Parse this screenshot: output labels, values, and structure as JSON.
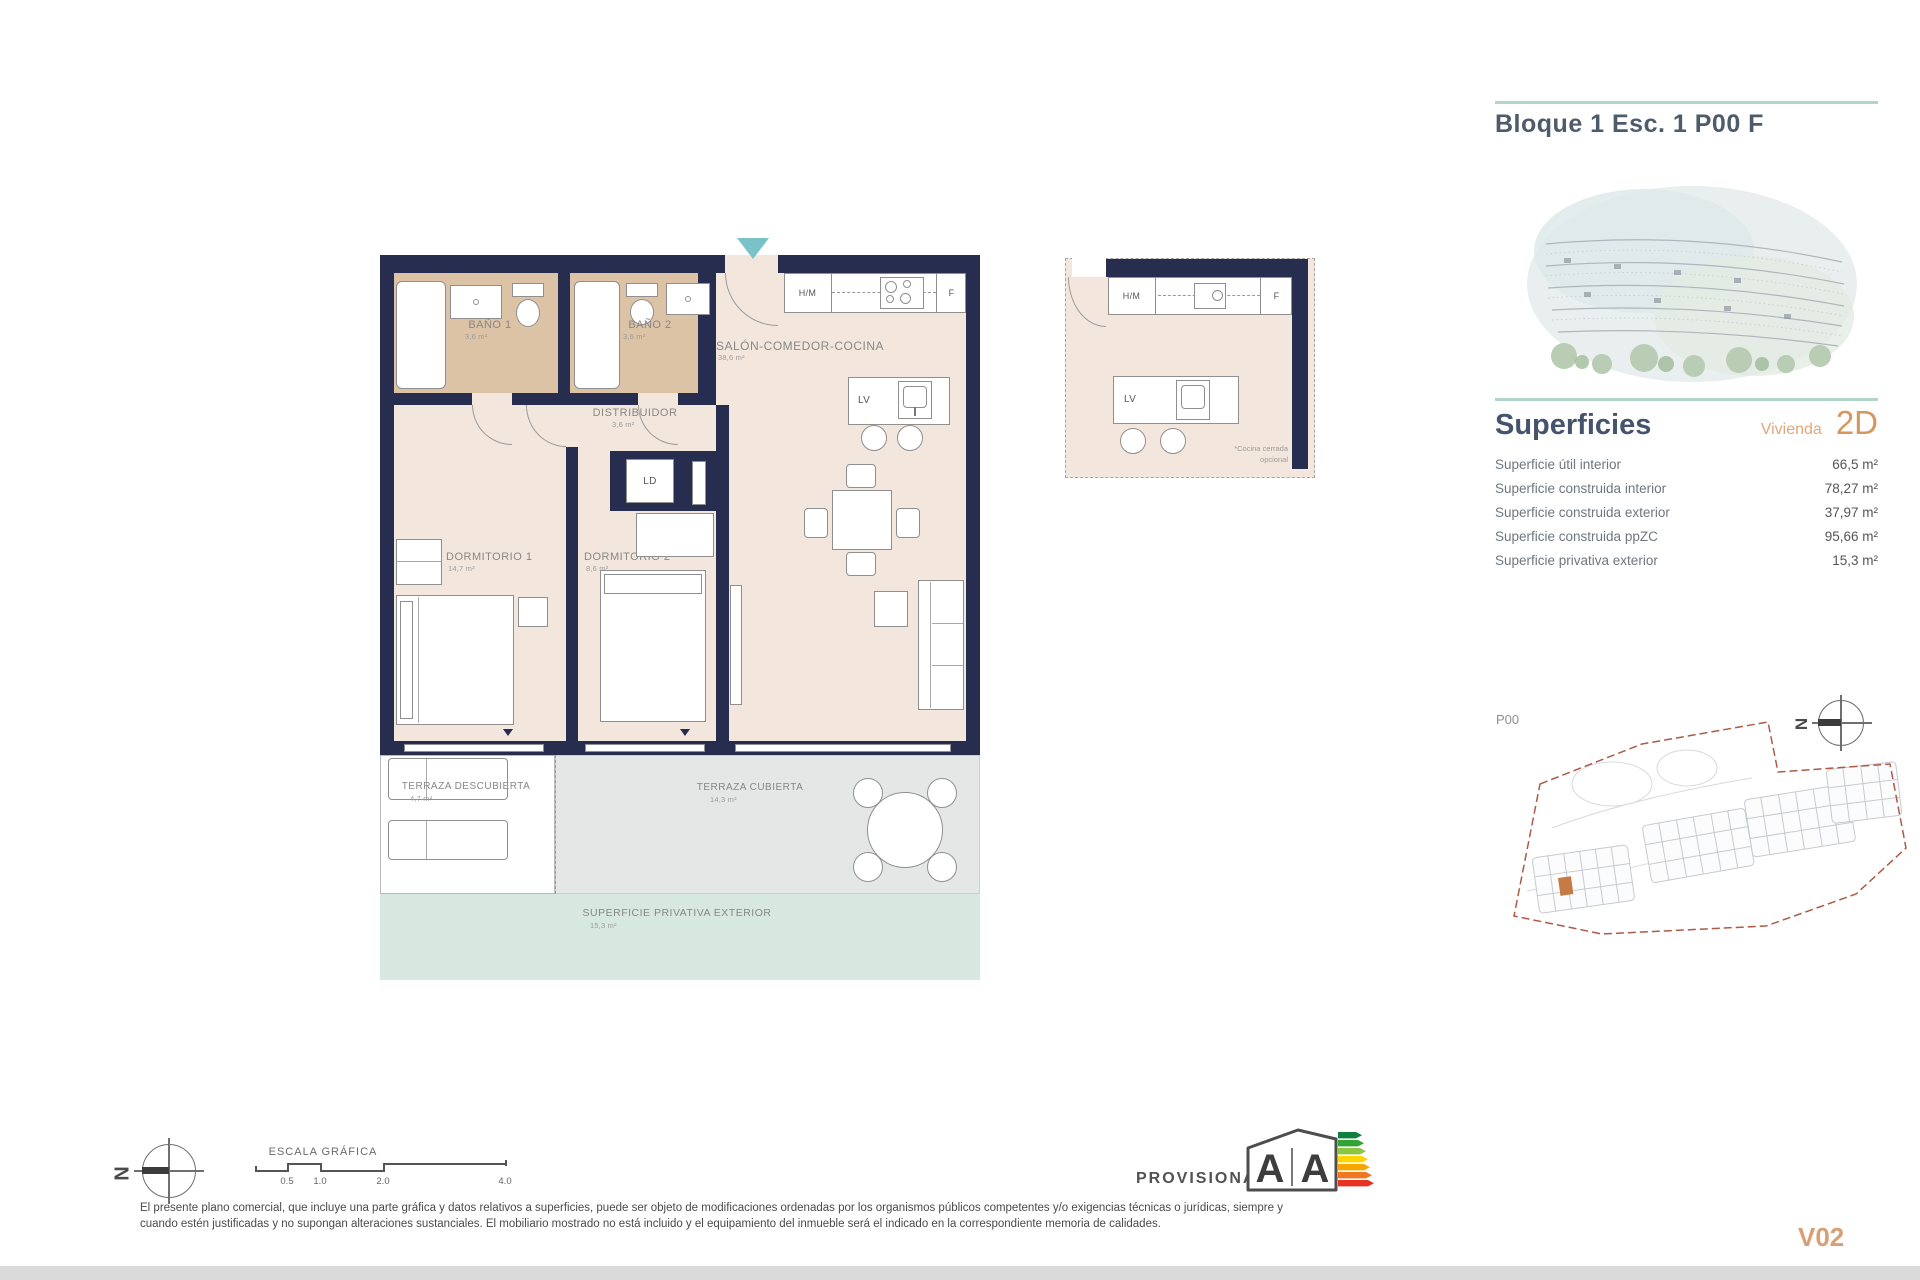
{
  "header": {
    "title": "Bloque 1 Esc. 1 P00 F"
  },
  "superficies": {
    "heading": "Superficies",
    "vivienda_label": "Vivienda",
    "vivienda_code": "2D",
    "rows": [
      {
        "label": "Superficie útil interior",
        "value": "66,5 m²"
      },
      {
        "label": "Superficie construida interior",
        "value": "78,27 m²"
      },
      {
        "label": "Superficie construida exterior",
        "value": "37,97 m²"
      },
      {
        "label": "Superficie construida ppZC",
        "value": "95,66 m²"
      },
      {
        "label": "Superficie privativa exterior",
        "value": "15,3 m²"
      }
    ]
  },
  "floorplan": {
    "rooms": {
      "bano1": {
        "label": "BAÑO 1",
        "area": "3,6 m²"
      },
      "bano2": {
        "label": "BAÑO 2",
        "area": "3,6 m²"
      },
      "distribuidor": {
        "label": "DISTRIBUIDOR",
        "area": "3,6 m²"
      },
      "salon": {
        "label": "SALÓN-COMEDOR-COCINA",
        "area": "38,6 m²"
      },
      "dormitorio1": {
        "label": "DORMITORIO 1",
        "area": "14,7 m²"
      },
      "dormitorio2": {
        "label": "DORMITORIO 2",
        "area": "8,6 m²"
      },
      "terraza_descubierta": {
        "label": "TERRAZA DESCUBIERTA",
        "area": "4,7 m²"
      },
      "terraza_cubierta": {
        "label": "TERRAZA CUBIERTA",
        "area": "14,3 m²"
      },
      "superficie_privativa": {
        "label": "SUPERFICIE PRIVATIVA EXTERIOR",
        "area": "15,3 m²"
      }
    },
    "appliances": {
      "hm": "H/M",
      "f": "F",
      "lv": "LV",
      "ld": "LD"
    },
    "inset_note_line1": "*Cocina cerrada",
    "inset_note_line2": "opcional"
  },
  "siteplan": {
    "level": "P00",
    "boundary_color": "#ad5a47",
    "highlight_color": "#c67a45"
  },
  "compass_letter": "N",
  "colors": {
    "wall_navy": "#272d4e",
    "accent_teal": "#79c3c8",
    "rule_teal": "#b2d5ca",
    "orange": "#d6975f"
  },
  "footer": {
    "scale_label": "ESCALA GRÁFICA",
    "scale_ticks": [
      "0.5",
      "1.0",
      "2.0",
      "4.0"
    ],
    "provisional": "PROVISIONAL",
    "energy_letter_left": "A",
    "energy_letter_right": "A",
    "disclaimer_line1": "El presente plano comercial, que incluye una parte gráfica y datos relativos a superficies, puede ser objeto de modificaciones ordenadas por los organismos públicos competentes y/o exigencias técnicas o jurídicas, siempre y",
    "disclaimer_line2": "cuando estén justificadas y no supongan alteraciones sustanciales. El mobiliario mostrado no está incluido y el equipamiento del inmueble será el indicado en la correspondiente memoria de calidades.",
    "version": "V02"
  }
}
